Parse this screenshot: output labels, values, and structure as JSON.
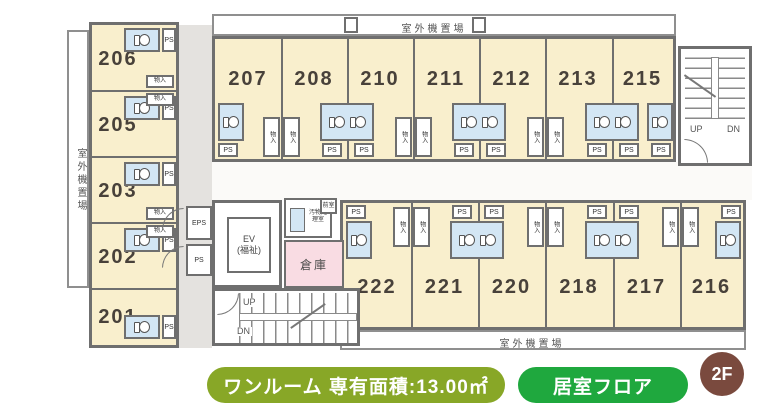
{
  "legend": {
    "unit_info": "ワンルーム 専有面積:13.00㎡",
    "floor_type": "居室フロア",
    "floor_badge": "2F"
  },
  "plan": {
    "rooms": {
      "left": [
        "206",
        "205",
        "203",
        "202",
        "201"
      ],
      "top": [
        "207",
        "208",
        "210",
        "211",
        "212",
        "213",
        "215"
      ],
      "bottom": [
        "222",
        "221",
        "220",
        "218",
        "217",
        "216"
      ]
    },
    "labels": {
      "outdoor_unit_top": "室外機置場",
      "outdoor_unit_bottom": "室外機置場",
      "outdoor_unit_left": "室外機置場",
      "elevator_line1": "EV",
      "elevator_line2": "(福祉)",
      "storage": "倉庫",
      "waste_room": "汚物処理室",
      "anteroom": "前室",
      "up": "UP",
      "down": "DN",
      "ps": "PS",
      "eps": "EPS",
      "closet": "物入"
    }
  },
  "colors": {
    "room_fill": "#f9efcd",
    "bathroom_fill": "#d3e6f4",
    "storage_fill": "#f9dce3",
    "corridor_fill": "#e4e2df",
    "wall": "#6f6f6f",
    "badge_olive": "#88a727",
    "badge_green": "#1fa83e",
    "badge_brown": "#7a4a3e"
  }
}
